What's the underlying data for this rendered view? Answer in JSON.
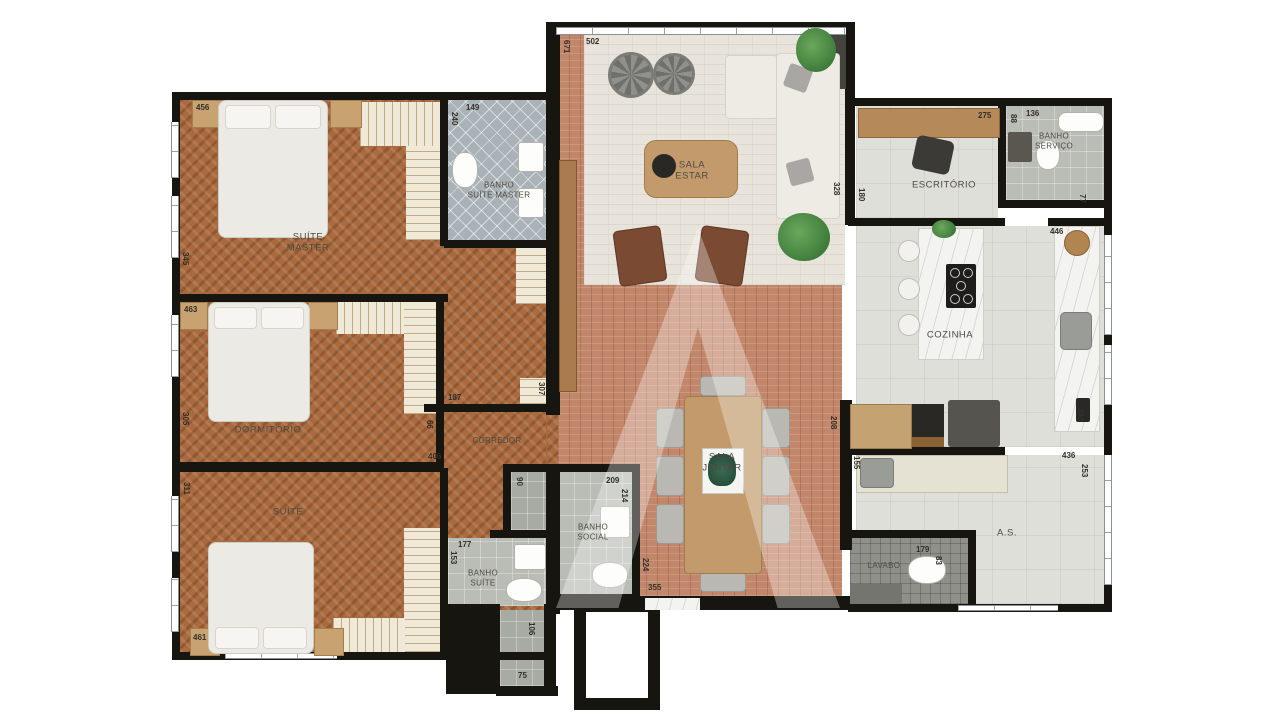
{
  "rooms": {
    "suite_master": "SUÍTE\nMASTER",
    "banho_suite_master": "BANHO\nSUÍTE MASTER",
    "dormitorio": "DORMITÓRIO",
    "suite": "SUÍTE",
    "banho_suite": "BANHO\nSUÍTE",
    "banho_social": "BANHO\nSOCIAL",
    "corredor": "CORREDOR",
    "sala_estar": "SALA\nESTAR",
    "sala_jantar": "SALA\nJANTAR",
    "escritorio": "ESCRITÓRIO",
    "banho_servico": "BANHO\nSERVIÇO",
    "cozinha": "COZINHA",
    "area_servico": "A.S.",
    "lavabo": "LAVABO"
  },
  "dims": {
    "d456": "456",
    "d345": "345",
    "d463": "463",
    "d305": "305",
    "d311": "311",
    "d461": "461",
    "d149": "149",
    "d240": "240",
    "d187": "187",
    "d307": "307",
    "d66": "66",
    "d406": "406",
    "d90": "90",
    "d209": "209",
    "d214": "214",
    "d177": "177",
    "d153": "153",
    "d106": "106",
    "d75": "75",
    "d671": "671",
    "d502": "502",
    "d328": "328",
    "d180": "180",
    "d275": "275",
    "d136": "136",
    "d88": "88",
    "d77": "77",
    "d446": "446",
    "d382": "382",
    "d208": "208",
    "d155": "155",
    "d436": "436",
    "d253": "253",
    "d179": "179",
    "d83": "83",
    "d355": "355",
    "d224": "224"
  },
  "colors": {
    "wall": "#17150f",
    "wood_floor": "#ab6a3d",
    "brick_floor": "#c2876a",
    "stone_floor": "#e8e4db",
    "bath_tile": "#b9bdb5",
    "nightstand_tan": "#c9a271",
    "marble": "#f3f3f0"
  }
}
